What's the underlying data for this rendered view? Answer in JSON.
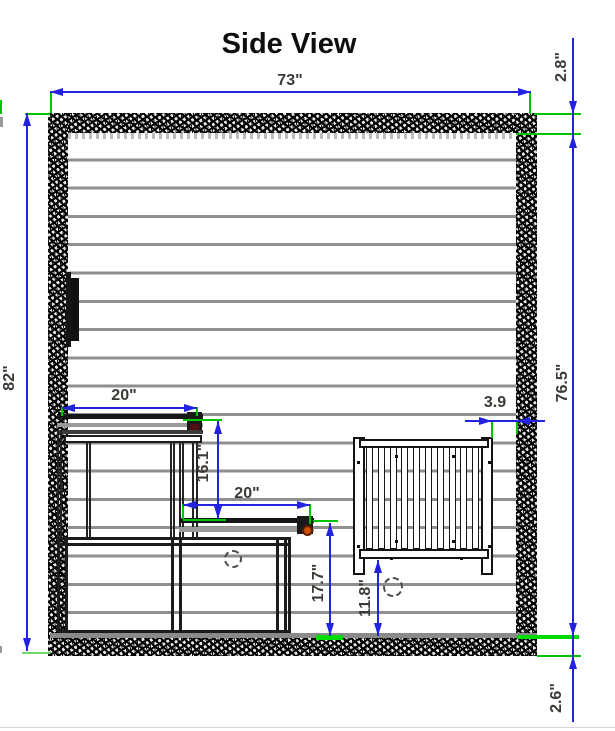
{
  "page": {
    "title": "Side View"
  },
  "dimensions": {
    "overall_width": "73\"",
    "top_wall_thickness": "2.8\"",
    "overall_height": "82\"",
    "interior_height": "76.5\"",
    "floor_thickness": "2.6\"",
    "upper_bench_depth": "20\"",
    "bench_vertical_gap": "16.1\"",
    "lower_bench_depth": "20\"",
    "lower_bench_height": "17.7\"",
    "heater_floor_clearance": "11.8\"",
    "heater_wall_gap": "3.9"
  },
  "colors": {
    "dimension_line_blue": "#2222e0",
    "extension_line_green": "#00c400",
    "highlight_green": "#00dc00",
    "dimension_text": "#3d3935",
    "wall_speckle": "#111111",
    "panel_line": "#8f8f8f",
    "bench_end_accent_red": "#4d0f0f",
    "bench_end_accent_orange": "#cf4f08"
  }
}
